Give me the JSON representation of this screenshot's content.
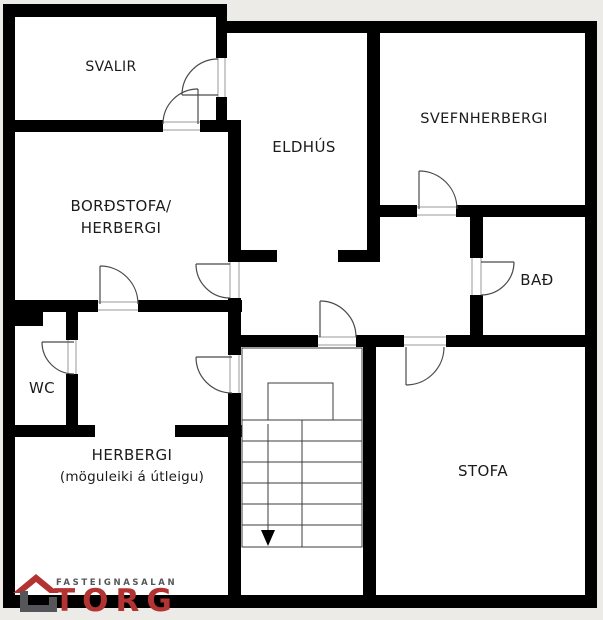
{
  "floor_plan": {
    "rooms": {
      "svalir": "SVALIR",
      "eldhus": "ELDHÚS",
      "svefnherbergi": "SVEFNHERBERGI",
      "bordstofa_line1": "BORÐSTOFA/",
      "bordstofa_line2": "HERBERGI",
      "bad": "BAÐ",
      "wc": "WC",
      "herbergi_line1": "HERBERGI",
      "herbergi_line2": "(möguleiki á útleigu)",
      "stofa": "STOFA"
    },
    "stairs": {
      "direction_arrow": "down"
    },
    "logo": {
      "tagline": "FASTEIGNASALAN",
      "brand": "TORG"
    },
    "colors": {
      "wall": "#000000",
      "floor": "#ffffff",
      "background": "#ecebe8",
      "door_line": "#4a4a4a",
      "opening_line": "#9a9a9a",
      "stair_line": "#3c3c3c",
      "logo_red": "#b23331",
      "logo_gray": "#54565a"
    }
  }
}
